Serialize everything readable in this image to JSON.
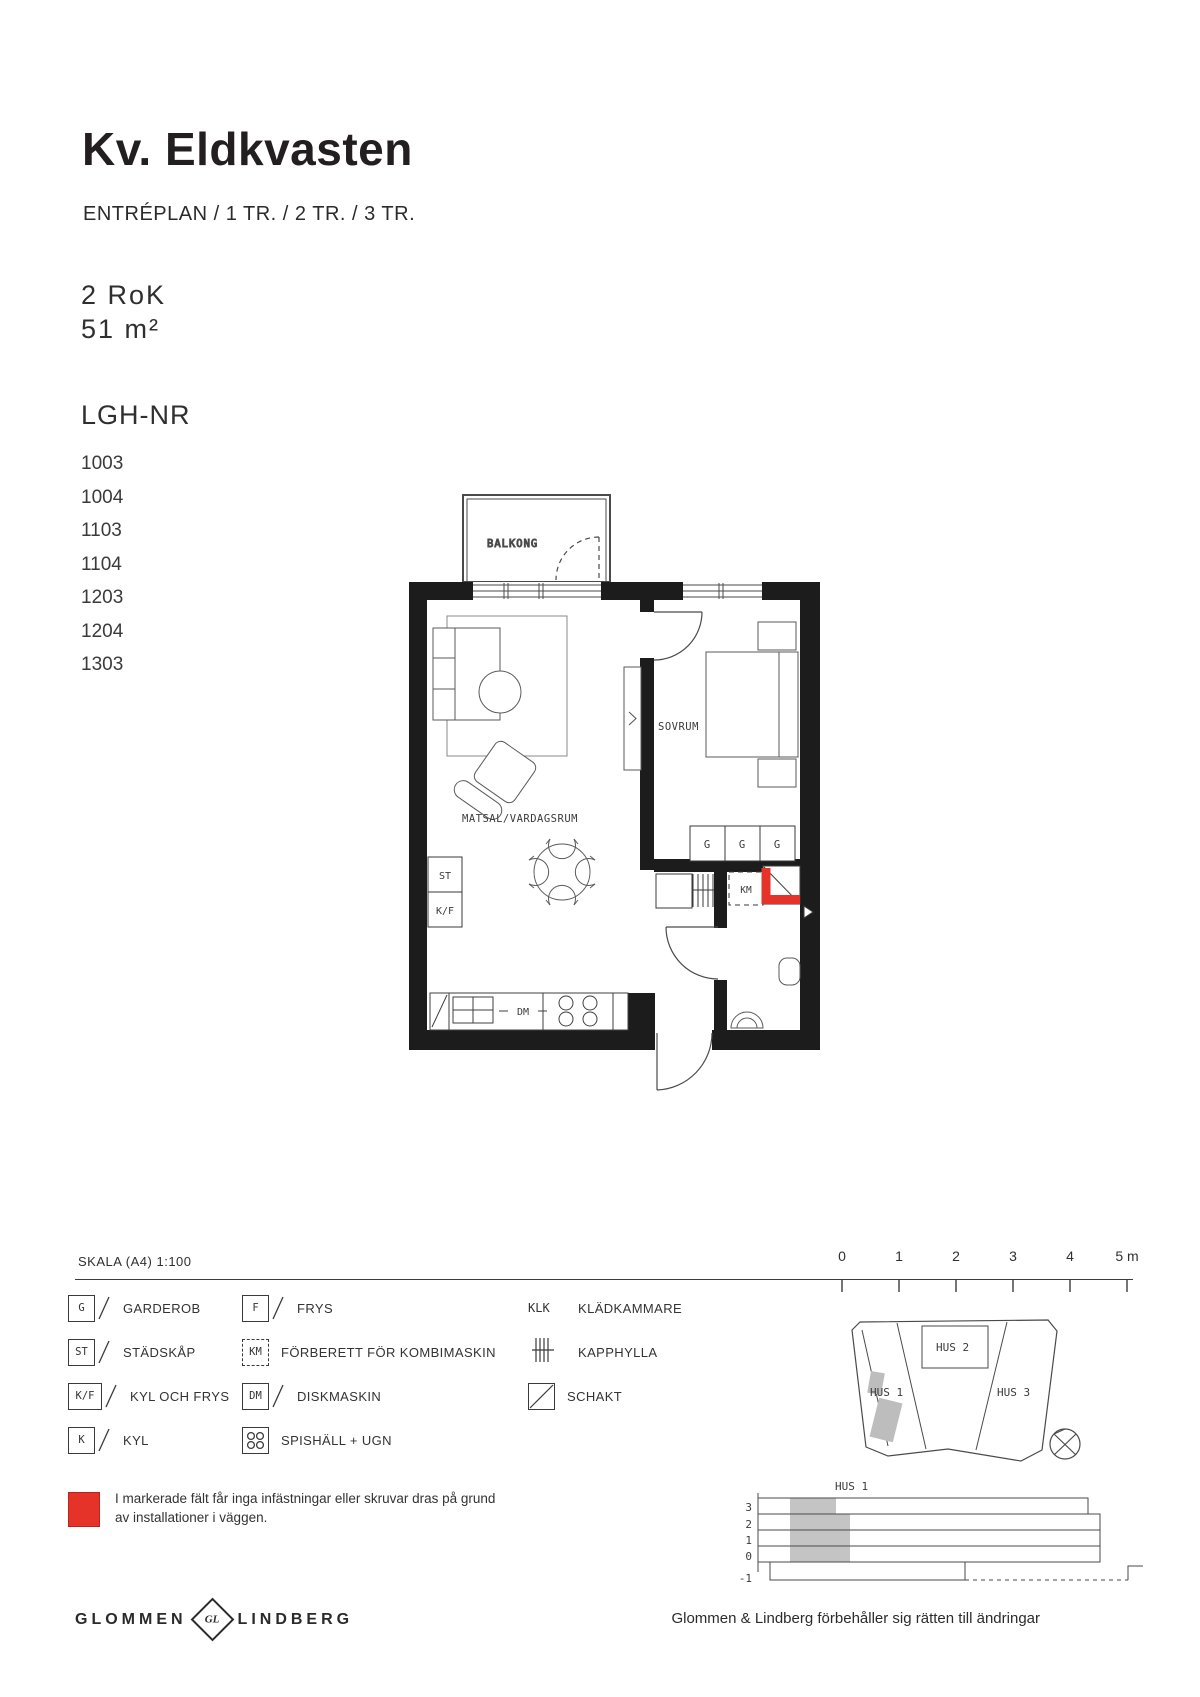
{
  "header": {
    "title": "Kv. Eldkvasten",
    "subtitle": "ENTRÉPLAN / 1 TR. / 2 TR. / 3 TR.",
    "rooms": "2 RoK",
    "area": "51 m²"
  },
  "apartments": {
    "label": "LGH-NR",
    "numbers": [
      "1003",
      "1004",
      "1103",
      "1104",
      "1203",
      "1204",
      "1303"
    ]
  },
  "floorplan": {
    "rooms": {
      "balcony": "BALKONG",
      "bedroom": "SOVRUM",
      "living": "MATSAL/VARDAGSRUM"
    },
    "markers": {
      "st": "ST",
      "kf": "K/F",
      "g": "G",
      "km": "KM",
      "dm": "DM"
    }
  },
  "scale": {
    "label": "SKALA (A4) 1:100",
    "ticks": [
      "0",
      "1",
      "2",
      "3",
      "4",
      "5 m"
    ]
  },
  "legend": {
    "col1": [
      {
        "symbol": "G",
        "label": "GARDEROB"
      },
      {
        "symbol": "ST",
        "label": "STÄDSKÅP"
      },
      {
        "symbol": "K/F",
        "label": "KYL OCH FRYS"
      },
      {
        "symbol": "K",
        "label": "KYL"
      }
    ],
    "col2": [
      {
        "symbol": "F",
        "label": "FRYS"
      },
      {
        "symbol": "KM",
        "label": "FÖRBERETT FÖR KOMBIMASKIN"
      },
      {
        "symbol": "DM",
        "label": "DISKMASKIN"
      },
      {
        "symbol": "spishall-ugn-icon",
        "label": "SPISHÄLL + UGN"
      }
    ],
    "col3": [
      {
        "symbol": "KLK",
        "label": "KLÄDKAMMARE"
      },
      {
        "symbol": "kapphylla-icon",
        "label": "KAPPHYLLA"
      },
      {
        "symbol": "schakt-icon",
        "label": "SCHAKT"
      }
    ]
  },
  "note": {
    "line1": "I markerade fält får inga infästningar eller skruvar dras på grund",
    "line2": "av installationer i väggen."
  },
  "siteplan": {
    "hus1": "HUS 1",
    "hus2": "HUS 2",
    "hus3": "HUS 3"
  },
  "section": {
    "title": "HUS 1",
    "levels": [
      "3",
      "2",
      "1",
      "0",
      "-1"
    ]
  },
  "footer": {
    "brand_left": "GLOMMEN",
    "brand_monogram": "GL",
    "brand_right": "LINDBERG",
    "disclaimer": "Glommen & Lindberg förbehåller sig rätten till ändringar"
  },
  "colors": {
    "wall": "#1c1c1c",
    "red": "#e6332a",
    "grey_fill": "#c4c4c4",
    "grey_text": "#9a9a9a"
  }
}
